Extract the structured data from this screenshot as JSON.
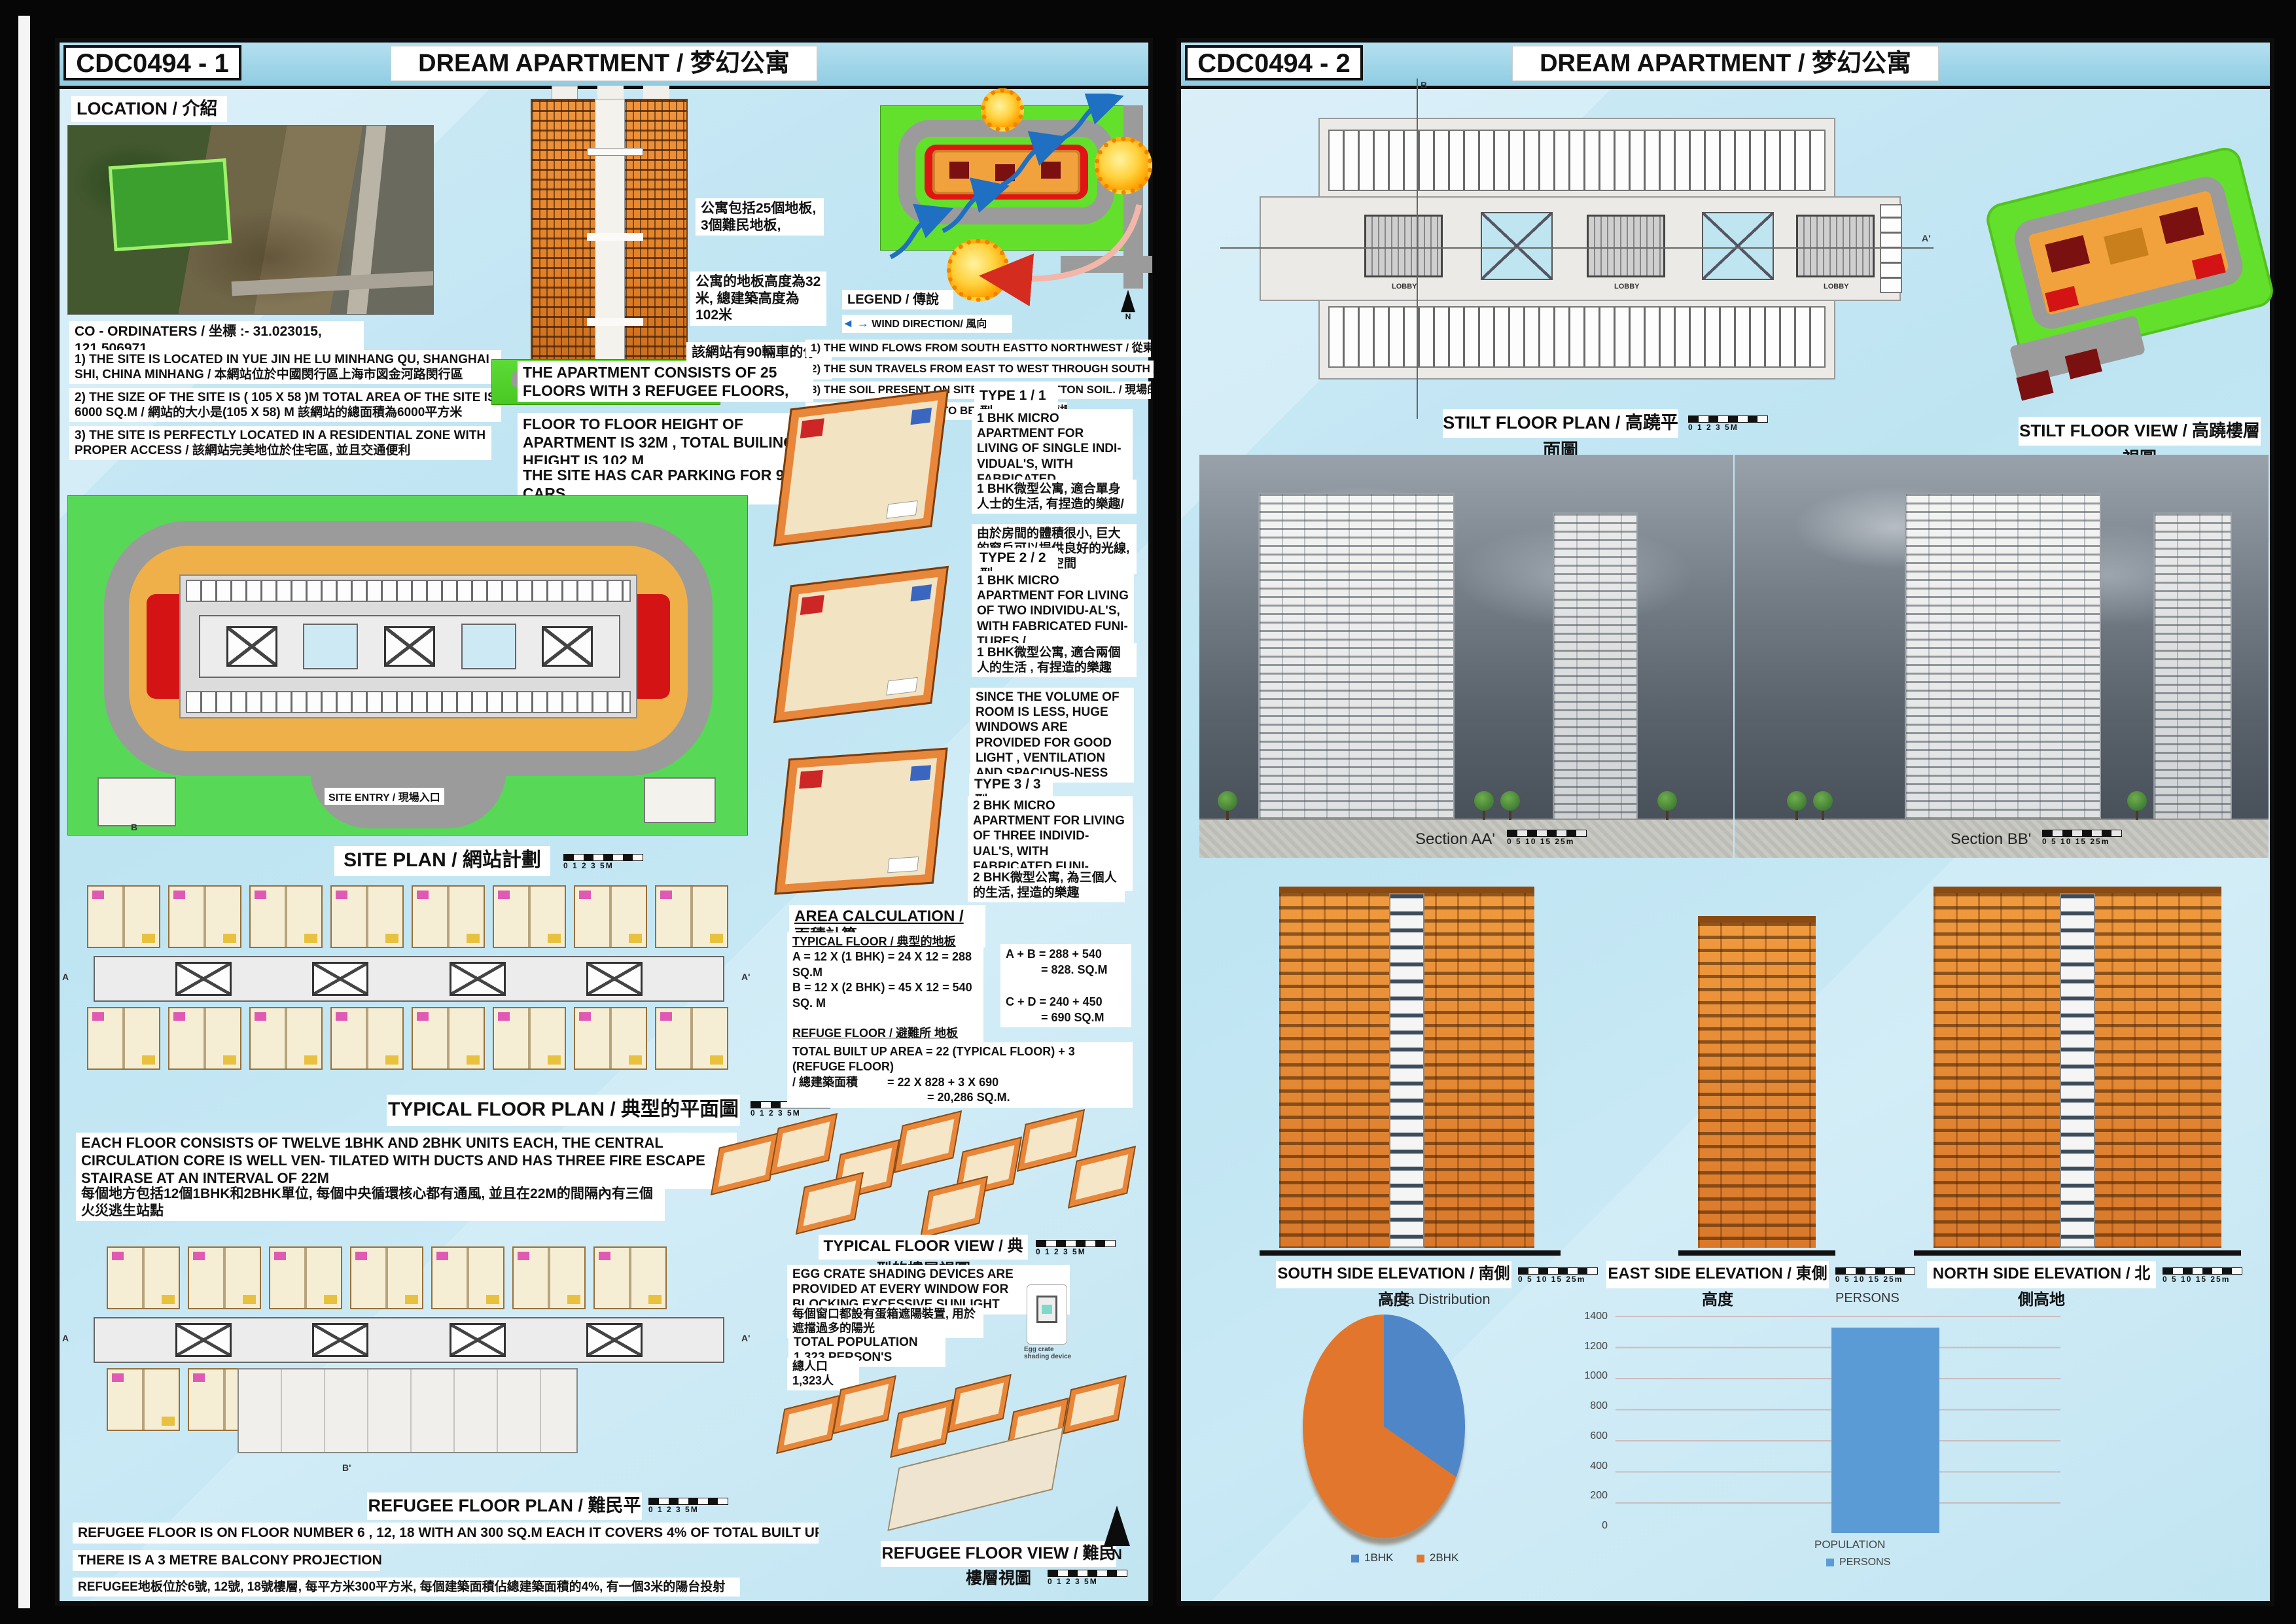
{
  "panels": [
    {
      "code": "CDC0494 - 1",
      "title": "DREAM APARTMENT /  梦幻公寓",
      "location_label": "LOCATION / 介紹",
      "coords": "CO - ORDINATERS / 坐標 :- 31.023015, 121.506971",
      "notes": [
        "1) THE SITE IS LOCATED IN  YUE JIN HE LU MINHANG QU, SHANGHAI SHI, CHINA MINHANG / 本網站位於中國閔行區上海市図金河路閔行區",
        "2) THE SIZE OF THE SITE IS ( 105 X 58 )M    TOTAL AREA OF THE SITE IS 6000 SQ.M  / 網站的大小是(105 X 58) M 該網站的總面積為6000平方米",
        "3) THE SITE IS PERFECTLY LOCATED IN A RESIDENTIAL ZONE WITH PROPER ACCESS / 該網站完美地位於住宅區, 並且交通便利"
      ],
      "cn_facts": [
        "公寓包括25個地板, 3個難民地板,",
        "公寓的地板高度為32米, 總建築高度為102米",
        "該網站有90輛車的停車位"
      ],
      "en_facts": [
        "THE APARTMENT CONSISTS OF 25 FLOORS WITH 3 REFUGEE FLOORS,",
        "FLOOR TO FLOOR HEIGHT OF APARTMENT IS 32M , TOTAL BUILING HEIGHT IS 102 M",
        "THE SITE HAS CAR PARKING FOR 90 CARS"
      ],
      "legend_label": "LEGEND / 傳說",
      "wind_label": "WIND DIRECTION/ 風向",
      "legend_notes": [
        "1) THE WIND FLOWS FROM SOUTH EASTTO NORTHWEST / 從東南到西北的風流",
        "2) THE SUN TRAVELS FROM EAST TO WEST THROUGH SOUTH / 從東到西的太陽旅行",
        "3) THE SOIL PRESENT ON SITE IS BLACK COTTON SOIL. /  現場的土壤是黑色的棉土",
        "4) PILE FOUNDATION IS TO BE PROVIDED. / 應提供樁基礎"
      ],
      "site_entry": "SITE ENTRY / 現場入口",
      "site_plan_caption": "SITE PLAN  /  網站計劃",
      "types": [
        {
          "title": "TYPE 1 / 1型",
          "en": "1 BHK  MICRO APARTMENT FOR LIVING OF SINGLE INDI-VIDUAL'S, WITH FABRICATED FUNITURES /",
          "cn": "1 BHK微型公寓, 適合單身人士的生活, 有捏造的樂趣/",
          "extra": "由於房間的體積很小, 巨大的窗戶可以提供良好的光線, 通風和寬敞的空間"
        },
        {
          "title": "TYPE 2 / 2型",
          "en": "1 BHK  MICRO APARTMENT FOR LIVING OF TWO INDIVIDU-AL'S, WITH FABRICATED FUNI-TURES /",
          "cn": "1 BHK微型公寓, 適合兩個人的生活 , 有捏造的樂趣",
          "extra": "SINCE THE VOLUME OF ROOM IS LESS, HUGE WINDOWS ARE PROVIDED FOR GOOD LIGHT , VENTILATION AND SPACIOUS-NESS"
        },
        {
          "title": "TYPE 3 / 3型",
          "en": "2 BHK  MICRO APARTMENT FOR LIVING OF THREE INDIVID-UAL'S, WITH FABRICATED FUNI-TURES /",
          "cn": "2 BHK微型公寓, 為三個人的生活, 捏造的樂趣",
          "extra": ""
        }
      ],
      "area_calc": {
        "title": "AREA CALCULATION / 面積計算",
        "typical_label": "TYPICAL FLOOR / 典型的地板",
        "lineA": "A = 12 X (1 BHK) = 24 X 12 = 288 SQ.M",
        "lineB": "B = 12 X (2 BHK) = 45 X 12 = 540 SQ. M",
        "refuge_label": "REFUGE FLOOR / 避難所 地板",
        "lineC": "C = 10 X (1 BHK) = 24 X 10 = 240 SQ. M.",
        "lineD": "D = 10 X (2 BHK) = 45 X 10 = 450 SQ.M.",
        "sum_ab1": "A + B =  288 + 540",
        "sum_ab2": "= 828. SQ.M",
        "sum_cd1": "C + D = 240 + 450",
        "sum_cd2": "= 690 SQ.M",
        "total1": "TOTAL  BUILT UP AREA = 22 (TYPICAL FLOOR) + 3 (REFUGE FLOOR)",
        "total2": "/  總建築面積",
        "total3": "= 22 X 828 + 3 X 690",
        "total4": "= 20,286 SQ.M."
      },
      "typical_plan_caption": "TYPICAL FLOOR PLAN / 典型的平面圖",
      "each_floor_en": "EACH FLOOR CONSISTS OF TWELVE 1BHK AND 2BHK UNITS EACH, THE CENTRAL CIRCULATION CORE IS WELL VEN- TILATED WITH DUCTS AND HAS THREE FIRE ESCAPE STAIRASE AT AN INTERVAL OF 22M",
      "each_floor_cn": "每個地方包括12個1BHK和2BHK單位, 每個中央循環核心都有通風, 並且在22M的間隔內有三個火災逃生站點",
      "typical_view_caption": "TYPICAL FLOOR VIEW / 典型的樓層視圖",
      "egg_en": "EGG CRATE SHADING DEVICES ARE PROVIDED AT EVERY WINDOW FOR BLOCKING EXCESSIVE SUNLIGHT",
      "egg_cn": "每個窗口都設有蛋箱遮陽裝置, 用於遮擋過多的陽光",
      "population_en": "TOTAL POPULATION 1,323 PERSON'S",
      "population_cn": "總人口1,323人",
      "egg_device": "Egg crate shading device",
      "refugee_plan_caption": "REFUGEE FLOOR PLAN / 難民平面圖",
      "refugee_notes": [
        "REFUGEE FLOOR IS ON FLOOR NUMBER 6 , 12, 18 WITH AN 300 SQ.M EACH IT COVERS 4% OF TOTAL BUILT UP AREA.",
        "THERE IS A 3 METRE BALCONY PROJECTION",
        "REFUGEE地板位於6號, 12號, 18號樓層, 每平方米300平方米, 每個建築面積佔總建築面積的4%, 有一個3米的陽台投射"
      ],
      "refugee_view_caption": "REFUGEE FLOOR VIEW / 難民樓層視圖",
      "scale_small": "0  1  2  3      5M",
      "grid": {
        "a": "A",
        "a2": "A'",
        "b": "B",
        "b2": "B'"
      },
      "north_label": "N"
    },
    {
      "code": "CDC0494 - 2",
      "title": "DREAM APARTMENT /  梦幻公寓",
      "stilt_plan_caption": "STILT FLOOR PLAN / 高蹺平面圖",
      "stilt_view_caption": "STILT FLOOR VIEW / 高蹺樓層視圖",
      "lobby": "LOBBY",
      "grid": {
        "a": "A",
        "a2": "A'",
        "b": "B",
        "b2": "B'"
      },
      "section_aa": "Section AA'",
      "section_bb": "Section BB'",
      "scale_section": "0  5  10  15     25m",
      "elevations": [
        "SOUTH SIDE ELEVATION / 南側高度",
        "EAST SIDE ELEVATION / 東側高度",
        "NORTH SIDE ELEVATION / 北側高地"
      ]
    }
  ],
  "colors": {
    "panel_bg": "#c4e6f3",
    "site_green": "#57d957",
    "site_yellow": "#efb049",
    "road_gray": "#9b9b9b",
    "building_orange": "#e8863a",
    "accent_red": "#d41414",
    "pie_blue": "#4e86c8",
    "pie_orange": "#e2762c",
    "bar_blue": "#5b9bd5"
  },
  "chart_data": [
    {
      "type": "pie",
      "title": "Area Distribution",
      "labels": [
        "1BHK",
        "2BHK"
      ],
      "values": [
        288,
        540
      ],
      "unit": "SQ.M per typical floor",
      "percentages": [
        34.8,
        65.2
      ],
      "colors": [
        "#4e86c8",
        "#e2762c"
      ],
      "legend_position": "bottom"
    },
    {
      "type": "bar",
      "title": "PERSONS",
      "categories": [
        "POPULATION"
      ],
      "series": [
        {
          "name": "PERSONS",
          "values": [
            1323
          ]
        }
      ],
      "ylim": [
        0,
        1400
      ],
      "yticks": [
        0,
        200,
        400,
        600,
        800,
        1000,
        1200,
        1400
      ],
      "bar_color": "#5b9bd5",
      "grid": true,
      "legend_position": "bottom"
    }
  ]
}
